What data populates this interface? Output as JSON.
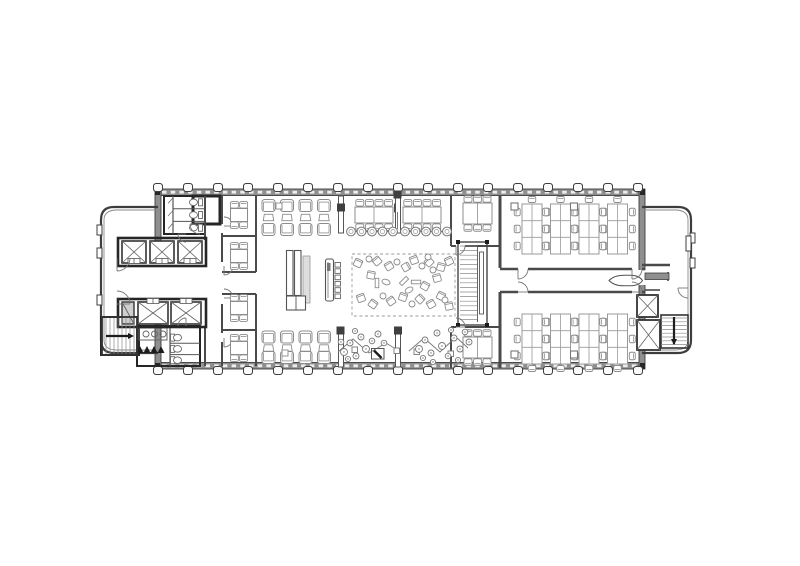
{
  "meta": {
    "kind": "architectural-floor-plan",
    "floor": "open-office-level"
  },
  "palette": {
    "bg": "#ffffff",
    "wall": "#3d3d3d",
    "core": "#262626",
    "poche": "#8f8f8f",
    "furn": "#8c8c8c",
    "furnLight": "#a0a0a0",
    "dark": "#1c1c1c",
    "glass": "#f0f0f0"
  },
  "canvas": {
    "w": 800,
    "h": 566
  },
  "plan": {
    "facade": {
      "bands": [
        [
          156,
          189,
          484,
          6.5
        ],
        [
          156,
          362.5,
          484,
          6.5
        ]
      ],
      "dashY": [
        192.2,
        365.8
      ],
      "endWalls": [
        [
          155,
          189,
          6,
          180
        ],
        [
          639,
          189,
          6,
          180
        ]
      ],
      "endGaps": [
        [
          153.5,
          251,
          9,
          58
        ],
        [
          637.5,
          270,
          9,
          15
        ]
      ],
      "cornerPosts": [
        [
          155,
          189
        ],
        [
          640,
          189
        ],
        [
          155,
          363
        ],
        [
          640,
          363
        ]
      ],
      "tickXs": [
        158,
        188,
        218,
        248,
        278,
        308,
        338,
        368,
        398,
        428,
        458,
        488,
        518,
        548,
        578,
        608,
        638
      ],
      "wings": [
        {
          "side": "left",
          "x0": 158,
          "xr": 101,
          "yt": 207,
          "yb": 353,
          "r": 13
        },
        {
          "side": "right",
          "x0": 642,
          "xr": 691,
          "yt": 207,
          "yb": 353,
          "r": 13
        }
      ],
      "bumps": [
        [
          97,
          225,
          5,
          10
        ],
        [
          97,
          248,
          5,
          10
        ],
        [
          97,
          295,
          5,
          10
        ],
        [
          690,
          233,
          5,
          10
        ],
        [
          690,
          258,
          5,
          10
        ]
      ],
      "recess": [
        686,
        236,
        5,
        15
      ]
    },
    "coreRooms": [
      {
        "name": "restroom-top",
        "r": [
          164,
          196,
          41,
          38
        ],
        "w": 2
      },
      {
        "name": "service-room-top",
        "r": [
          193,
          196,
          27,
          28
        ],
        "w": 3
      },
      {
        "name": "stair-room-left",
        "r": [
          101,
          317,
          38,
          38
        ],
        "w": 2
      },
      {
        "name": "restroom-bottom-block",
        "r": [
          137,
          326,
          63,
          40
        ],
        "w": 2
      }
    ],
    "restroomTop": {
      "stallX": 173,
      "x2": 205,
      "divYs": [
        208.7,
        221.4
      ],
      "wcCys": [
        202.3,
        215,
        227.7
      ],
      "tankX": 198.5,
      "bowlCx": 193.5
    },
    "restroomBottom": {
      "stallX": 170,
      "x2": 200,
      "divYs": [
        343.3,
        354.6
      ],
      "wcCys": [
        337.6,
        348.9,
        360.2
      ],
      "tankX": 170.5,
      "bowlCx": 177.5
    },
    "sinks": {
      "counter": [
        139,
        328,
        28,
        12
      ],
      "cys": 334,
      "cxs": [
        146,
        154.5,
        163
      ]
    },
    "urinalXs": [
      140,
      147,
      154,
      161
    ],
    "urinalY": 353,
    "elevTop": {
      "bank": [
        118,
        238,
        88,
        28
      ],
      "cars": [
        [
          122,
          241
        ],
        [
          150,
          241
        ],
        [
          178,
          241
        ]
      ],
      "carW": 24,
      "carH": 22,
      "doorY": 258.5
    },
    "elevBottom": {
      "bank": [
        118,
        299,
        88,
        28
      ],
      "service": [
        122,
        302,
        12,
        22
      ],
      "cars": [
        [
          138,
          302
        ],
        [
          171,
          302
        ]
      ],
      "carW": 30,
      "carH": 22,
      "doorY": 298.5
    },
    "walls": [
      [
        222,
        196,
        222,
        224
      ],
      [
        222,
        233,
        222,
        262
      ],
      [
        222,
        304,
        222,
        333
      ],
      [
        222,
        342,
        222,
        366
      ],
      [
        256,
        196,
        256,
        272
      ],
      [
        256,
        294,
        256,
        366
      ],
      [
        222,
        236,
        256,
        236
      ],
      [
        222,
        272,
        256,
        272
      ],
      [
        222,
        294,
        256,
        294
      ],
      [
        222,
        330,
        256,
        330
      ],
      [
        205,
        196,
        205,
        240
      ],
      [
        205,
        326,
        205,
        366
      ],
      [
        500,
        196,
        500,
        268,
        3
      ],
      [
        500,
        292,
        500,
        368,
        3
      ],
      [
        500,
        269,
        518,
        269,
        2.6
      ],
      [
        528,
        269,
        632,
        269,
        2.6
      ],
      [
        642,
        269,
        645,
        269,
        2.6
      ],
      [
        500,
        292,
        518,
        292,
        2.6
      ],
      [
        528,
        292,
        632,
        292,
        2.6
      ],
      [
        642,
        292,
        645,
        292,
        2.6
      ],
      [
        451,
        196,
        451,
        246,
        2
      ],
      [
        451,
        246,
        456,
        246,
        2
      ],
      [
        465,
        246,
        501,
        246,
        2
      ],
      [
        451,
        327,
        451,
        368,
        2
      ],
      [
        451,
        327,
        456,
        327,
        2
      ],
      [
        465,
        327,
        501,
        327,
        2
      ],
      [
        642,
        265,
        670,
        265,
        2.6
      ],
      [
        668,
        272,
        668,
        281,
        1.6
      ],
      [
        645,
        290,
        660,
        290,
        1.6
      ]
    ],
    "corridorBar": [
      645,
      273,
      24,
      6.5
    ],
    "lens": "M609,280.5 Q614,275.2 624,275.2 L630,275.2 Q639,275.2 642.5,280.5 Q639,285.8 630,285.8 L624,285.8 Q614,285.8 609,280.5 Z",
    "doors": [
      [
        224,
        226,
        9,
        0,
        90
      ],
      [
        224,
        266,
        9,
        270,
        360
      ],
      [
        224,
        298,
        9,
        0,
        90
      ],
      [
        224,
        338,
        9,
        270,
        360
      ],
      [
        200,
        224,
        10,
        180,
        270
      ],
      [
        456,
        246,
        9,
        270,
        360
      ],
      [
        456,
        327,
        9,
        0,
        90
      ],
      [
        518,
        269,
        10,
        270,
        360
      ],
      [
        518,
        292,
        10,
        0,
        90
      ],
      [
        632,
        269,
        10,
        270,
        360
      ],
      [
        632,
        292,
        10,
        0,
        90
      ],
      [
        688,
        288,
        10,
        180,
        270
      ],
      [
        117,
        258,
        13,
        270,
        360
      ],
      [
        117,
        304,
        13,
        0,
        90
      ],
      [
        186,
        234,
        8,
        180,
        270
      ],
      [
        186,
        326,
        8,
        90,
        180
      ]
    ],
    "meetingTables4": [
      {
        "cx": 239,
        "cy": 215
      },
      {
        "cx": 239,
        "cy": 256
      },
      {
        "cx": 239,
        "cy": 308
      },
      {
        "cx": 239,
        "cy": 348
      }
    ],
    "meetingTables6": [
      {
        "x": 463,
        "y": 203
      },
      {
        "x": 463,
        "y": 337
      }
    ],
    "longTables": [
      {
        "x": 355,
        "y": 207
      },
      {
        "x": 403,
        "y": 207
      }
    ],
    "blackPost": [
      394,
      203.5,
      7,
      9
    ],
    "loungePairs": {
      "cxs": [
        268.5,
        287,
        305.5,
        324
      ],
      "top": {
        "chair1": 205.5,
        "ottoman": 217.5,
        "chair2": 229.5
      },
      "bottom": {
        "chair1": 337,
        "ottoman": 348,
        "chair2": 357.5
      },
      "sideTables": [
        [
          276,
          203
        ],
        [
          282,
          350
        ]
      ]
    },
    "screens": [
      {
        "x": 338.5,
        "y": 196,
        "cap": [
          337,
          203.5
        ]
      },
      {
        "x": 395.5,
        "y": 196,
        "cap": [
          393.5,
          190.5
        ]
      },
      {
        "x": 338.5,
        "y": 330,
        "cap": [
          336.5,
          326.5
        ]
      },
      {
        "x": 395.5,
        "y": 330,
        "cap": [
          394,
          326.5
        ]
      }
    ],
    "stoolRows": [
      {
        "x1": 349,
        "x2": 395,
        "y": 231.5,
        "n": 5
      },
      {
        "x1": 403,
        "x2": 449,
        "y": 231.5,
        "n": 5
      }
    ],
    "counterDrop": [
      397.5,
      212,
      397.5,
      229
    ],
    "kitchen": {
      "tall": [
        [
          286.5,
          250.5,
          6.5,
          45
        ],
        [
          294.5,
          250.5,
          6.5,
          45
        ]
      ],
      "hatch": [
        303,
        256,
        7,
        47
      ],
      "low": [
        286.5,
        296,
        19,
        14
      ],
      "bar": [
        325.5,
        259,
        8,
        42
      ],
      "stools": {
        "x": 335,
        "y0": 262.5,
        "n": 6,
        "w": 5.5,
        "h": 4.6,
        "gap": 6.3
      }
    },
    "rug": [
      352,
      254,
      103,
      62
    ],
    "scatterChairs": [
      [
        358,
        263,
        25
      ],
      [
        377,
        261,
        -40
      ],
      [
        371,
        275,
        10
      ],
      [
        389,
        266,
        -30
      ],
      [
        406,
        267,
        60
      ],
      [
        414,
        260,
        -20
      ],
      [
        429,
        262,
        -45
      ],
      [
        441,
        267,
        15
      ],
      [
        449,
        261,
        -25
      ],
      [
        361,
        298,
        -20
      ],
      [
        373,
        304,
        35
      ],
      [
        391,
        301,
        -35
      ],
      [
        403,
        297,
        20
      ],
      [
        420,
        299,
        45
      ],
      [
        431,
        304,
        -30
      ],
      [
        441,
        296,
        25
      ],
      [
        449,
        306,
        -10
      ],
      [
        425,
        286,
        30
      ],
      [
        437,
        278,
        -15
      ]
    ],
    "scatterTables": [
      [
        369,
        259
      ],
      [
        397,
        262
      ],
      [
        422,
        266
      ],
      [
        383,
        296
      ],
      [
        412,
        304
      ],
      [
        433,
        270
      ],
      [
        445,
        300
      ],
      [
        428,
        257
      ]
    ],
    "scatterEllipses": [
      [
        386,
        282,
        20
      ],
      [
        409,
        290,
        -30
      ]
    ],
    "scatterBenches": [
      [
        377,
        283,
        0
      ],
      [
        416,
        282,
        90
      ],
      [
        404,
        281,
        45
      ]
    ],
    "plants": [
      [
        344,
        352,
        3.5
      ],
      [
        350,
        343,
        3
      ],
      [
        356,
        356,
        3
      ],
      [
        361,
        337,
        3
      ],
      [
        366,
        349,
        3.5
      ],
      [
        372,
        341,
        2.8
      ],
      [
        341,
        342,
        2.8
      ],
      [
        378,
        334,
        3
      ],
      [
        355,
        331,
        2.6
      ],
      [
        384,
        343,
        2.8
      ],
      [
        348,
        359,
        2.6
      ],
      [
        419,
        349,
        3.5
      ],
      [
        425,
        340,
        3
      ],
      [
        431,
        353,
        3
      ],
      [
        437,
        333,
        3
      ],
      [
        442,
        346,
        3.5
      ],
      [
        448,
        356,
        2.8
      ],
      [
        454,
        338,
        3
      ],
      [
        460,
        349,
        3
      ],
      [
        465,
        332,
        2.8
      ],
      [
        469,
        342,
        3
      ],
      [
        423,
        358,
        2.6
      ],
      [
        451,
        330,
        2.6
      ],
      [
        433,
        362,
        2.6
      ],
      [
        458,
        360,
        2.6
      ]
    ],
    "plantPaths": [
      [
        [
          338,
          352
        ],
        [
          353,
          339
        ],
        [
          369,
          353
        ],
        [
          386,
          343
        ],
        [
          399,
          351
        ]
      ],
      [
        [
          409,
          351
        ],
        [
          424,
          338
        ],
        [
          440,
          352
        ],
        [
          456,
          337
        ],
        [
          468,
          348
        ]
      ]
    ],
    "planters": [
      [
        352,
        347
      ],
      [
        394,
        348
      ],
      [
        414,
        349
      ],
      [
        448,
        351
      ]
    ],
    "miniSteps": {
      "r": [
        371.5,
        348.5,
        12.5,
        10.5
      ],
      "bar": [
        374,
        350.5,
        381.5,
        358
      ]
    },
    "stairCenter": {
      "x": 458,
      "y": 242,
      "w": 29,
      "h": 83
    },
    "stairLeft": {
      "x": 103,
      "y": 318,
      "w": 33,
      "h": 36
    },
    "stairRight": {
      "x": 661,
      "y": 315,
      "w": 27,
      "h": 33
    },
    "shaftsRight": [
      [
        637,
        295,
        21,
        22
      ],
      [
        637,
        320,
        23,
        30
      ]
    ],
    "benches": {
      "xs": [
        522,
        550.5,
        579,
        607.5
      ],
      "topY": 204,
      "bottomY": 314,
      "pedestals": [
        [
          511,
          203
        ],
        [
          570.5,
          203
        ],
        [
          511,
          351
        ],
        [
          570.5,
          351
        ]
      ]
    }
  }
}
